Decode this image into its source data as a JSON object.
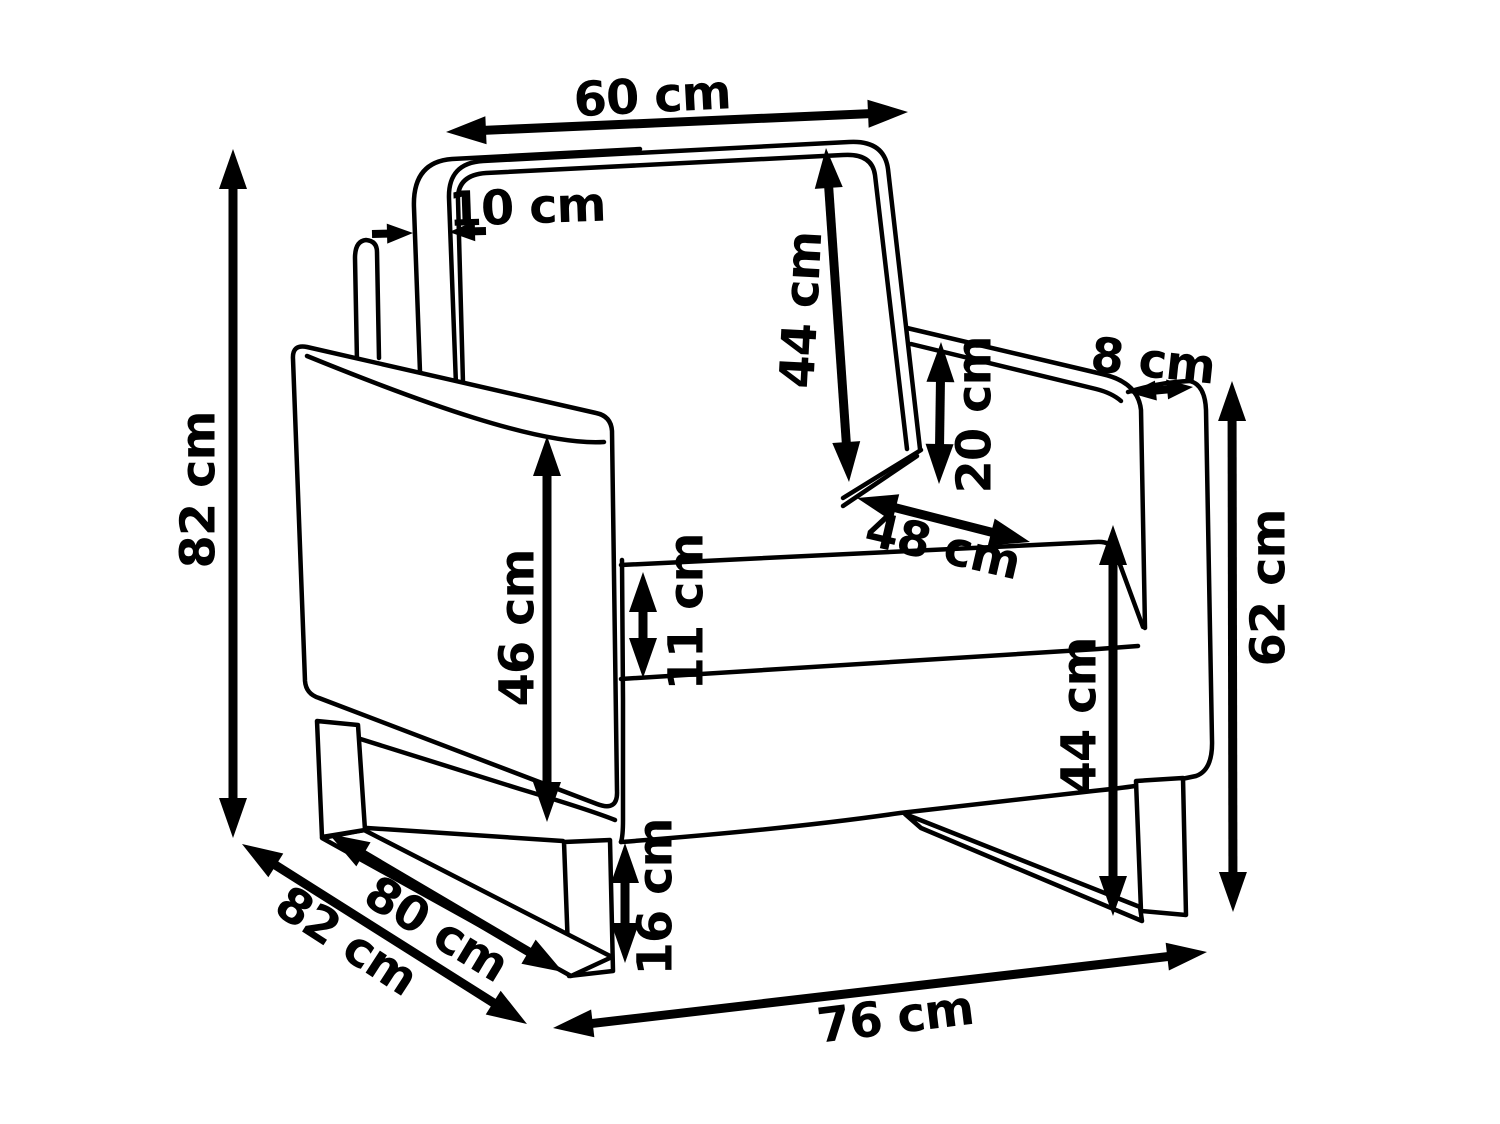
{
  "page": {
    "background": "#ffffff",
    "line_color": "#000000"
  },
  "figure": {
    "type": "technical-dimension-drawing",
    "subject": "armchair with metal sled legs",
    "unit": "cm"
  },
  "dimensions": [
    {
      "id": "backrest-top-width",
      "label": "60 cm",
      "value": 60,
      "arrows": [
        {
          "x1": 446,
          "y1": 132,
          "x2": 908,
          "y2": 112,
          "heads": "both"
        }
      ],
      "label_pos": {
        "x": 652,
        "y": 95,
        "rotate": -3
      }
    },
    {
      "id": "back-panel-thickness",
      "label": "10 cm",
      "value": 10,
      "arrows": [
        {
          "x1": 372,
          "y1": 234,
          "x2": 413,
          "y2": 233,
          "heads": "end"
        },
        {
          "x1": 486,
          "y1": 231,
          "x2": 449,
          "y2": 232,
          "heads": "end"
        }
      ],
      "label_pos": {
        "x": 527,
        "y": 206,
        "rotate": -2
      }
    },
    {
      "id": "backrest-height",
      "label": "44 cm",
      "value": 44,
      "arrows": [
        {
          "x1": 826,
          "y1": 148,
          "x2": 849,
          "y2": 482,
          "heads": "both"
        }
      ],
      "label_pos": {
        "x": 800,
        "y": 310,
        "rotate": -87
      }
    },
    {
      "id": "armrest-above-seat",
      "label": "20 cm",
      "value": 20,
      "arrows": [
        {
          "x1": 941,
          "y1": 342,
          "x2": 939,
          "y2": 484,
          "heads": "both"
        }
      ],
      "label_pos": {
        "x": 973,
        "y": 415,
        "rotate": -90
      }
    },
    {
      "id": "armrest-width",
      "label": "8 cm",
      "value": 8,
      "arrows": [
        {
          "x1": 1130,
          "y1": 393,
          "x2": 1193,
          "y2": 387,
          "heads": "both"
        }
      ],
      "label_pos": {
        "x": 1153,
        "y": 360,
        "rotate": 6
      }
    },
    {
      "id": "seat-depth",
      "label": "48 cm",
      "value": 48,
      "arrows": [
        {
          "x1": 857,
          "y1": 498,
          "x2": 1030,
          "y2": 542,
          "heads": "both"
        }
      ],
      "label_pos": {
        "x": 943,
        "y": 545,
        "rotate": 13
      }
    },
    {
      "id": "total-height",
      "label": "82 cm",
      "value": 82,
      "arrows": [
        {
          "x1": 233,
          "y1": 149,
          "x2": 233,
          "y2": 838,
          "heads": "both"
        }
      ],
      "label_pos": {
        "x": 197,
        "y": 490,
        "rotate": -90
      }
    },
    {
      "id": "armrest-panel-height",
      "label": "46 cm",
      "value": 46,
      "arrows": [
        {
          "x1": 547,
          "y1": 436,
          "x2": 547,
          "y2": 822,
          "heads": "both"
        }
      ],
      "label_pos": {
        "x": 516,
        "y": 628,
        "rotate": -90
      }
    },
    {
      "id": "seat-cushion-thickness",
      "label": "11 cm",
      "value": 11,
      "arrows": [
        {
          "x1": 643,
          "y1": 572,
          "x2": 643,
          "y2": 678,
          "heads": "both"
        }
      ],
      "label_pos": {
        "x": 685,
        "y": 612,
        "rotate": -90
      }
    },
    {
      "id": "armrest-floor-height",
      "label": "62 cm",
      "value": 62,
      "arrows": [
        {
          "x1": 1232,
          "y1": 381,
          "x2": 1233,
          "y2": 912,
          "heads": "both"
        }
      ],
      "label_pos": {
        "x": 1267,
        "y": 588,
        "rotate": -90
      }
    },
    {
      "id": "seat-height",
      "label": "44 cm",
      "value": 44,
      "arrows": [
        {
          "x1": 1113,
          "y1": 525,
          "x2": 1113,
          "y2": 916,
          "heads": "both"
        }
      ],
      "label_pos": {
        "x": 1078,
        "y": 716,
        "rotate": -90
      }
    },
    {
      "id": "leg-height",
      "label": "16 cm",
      "value": 16,
      "arrows": [
        {
          "x1": 625,
          "y1": 843,
          "x2": 625,
          "y2": 963,
          "heads": "both"
        }
      ],
      "label_pos": {
        "x": 654,
        "y": 897,
        "rotate": -90
      }
    },
    {
      "id": "total-depth",
      "label": "82 cm",
      "value": 82,
      "arrows": [
        {
          "x1": 242,
          "y1": 844,
          "x2": 527,
          "y2": 1024,
          "heads": "both"
        }
      ],
      "label_pos": {
        "x": 347,
        "y": 940,
        "rotate": 33
      }
    },
    {
      "id": "base-depth",
      "label": "80 cm",
      "value": 80,
      "arrows": [
        {
          "x1": 329,
          "y1": 834,
          "x2": 563,
          "y2": 972,
          "heads": "both"
        }
      ],
      "label_pos": {
        "x": 437,
        "y": 928,
        "rotate": 31
      }
    },
    {
      "id": "total-width",
      "label": "76 cm",
      "value": 76,
      "arrows": [
        {
          "x1": 553,
          "y1": 1028,
          "x2": 1207,
          "y2": 952,
          "heads": "both"
        }
      ],
      "label_pos": {
        "x": 895,
        "y": 1016,
        "rotate": -7
      }
    }
  ]
}
